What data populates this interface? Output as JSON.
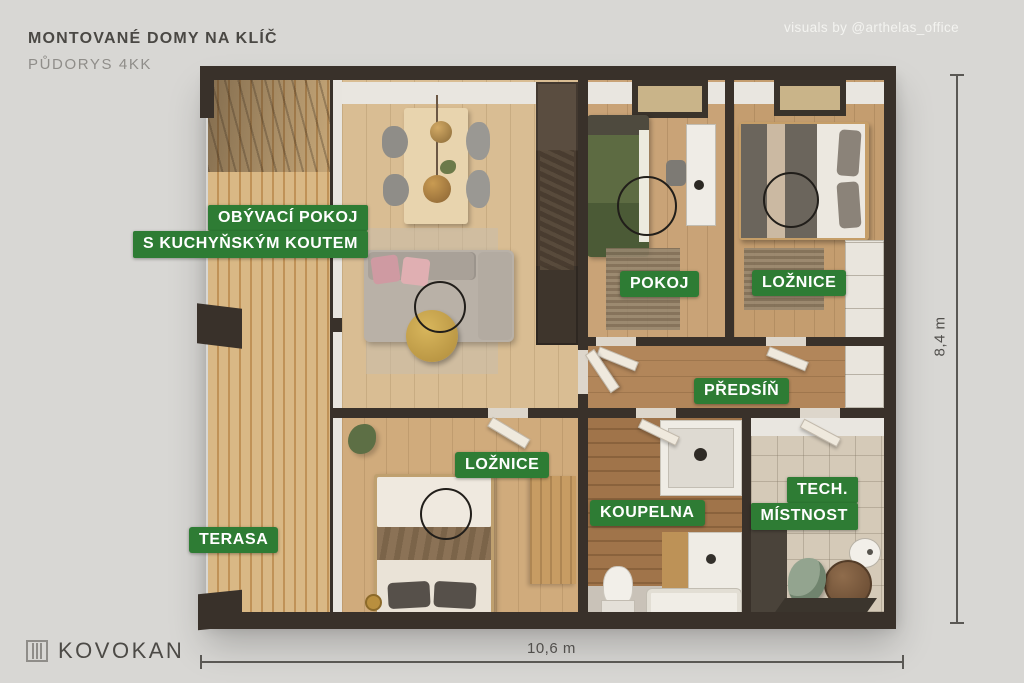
{
  "header": {
    "title": "MONTOVANÉ DOMY NA KLÍČ",
    "subtitle": "PŮDORYS 4KK"
  },
  "credit": "visuals by @arthelas_office",
  "brand": {
    "name": "KOVOKAN",
    "icon": "panel-house-icon"
  },
  "room_labels": {
    "living_line1": "OBÝVACÍ POKOJ",
    "living_line2": "S KUCHYŇSKÝM KOUTEM",
    "pokoj": "POKOJ",
    "loznice_top": "LOŽNICE",
    "predsin": "PŘEDSÍŇ",
    "loznice_bottom": "LOŽNICE",
    "koupelna": "KOUPELNA",
    "tech_line1": "TECH.",
    "tech_line2": "MÍSTNOST",
    "terasa": "TERASA"
  },
  "dimensions": {
    "width_label": "10,6 m",
    "height_label": "8,4 m"
  },
  "colors": {
    "label_green": "#2e7c34",
    "background": "#d8d7d4",
    "wall_dark": "#39312a"
  }
}
